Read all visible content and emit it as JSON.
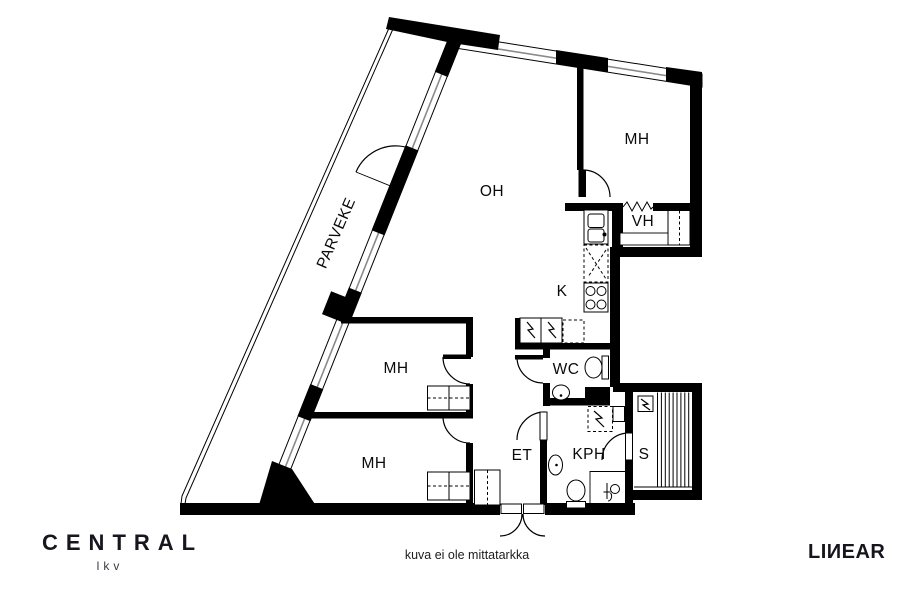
{
  "plan": {
    "balcony_label": "PARVEKE",
    "living_room_label": "OH",
    "bedroom_labels": [
      "MH",
      "MH",
      "MH"
    ],
    "closet_label": "VH",
    "kitchen_label": "K",
    "wc_label": "WC",
    "entry_label": "ET",
    "bathroom_label": "KPH",
    "sauna_label": "S"
  },
  "footer": {
    "disclaimer": "kuva ei ole mittatarkka"
  },
  "branding": {
    "agency": "CENTRAL",
    "agency_sub": "lkv",
    "vendor": "LIИEAR"
  },
  "colors": {
    "walls": "#000000",
    "glazing": "#8a8a8a",
    "background": "#ffffff"
  }
}
